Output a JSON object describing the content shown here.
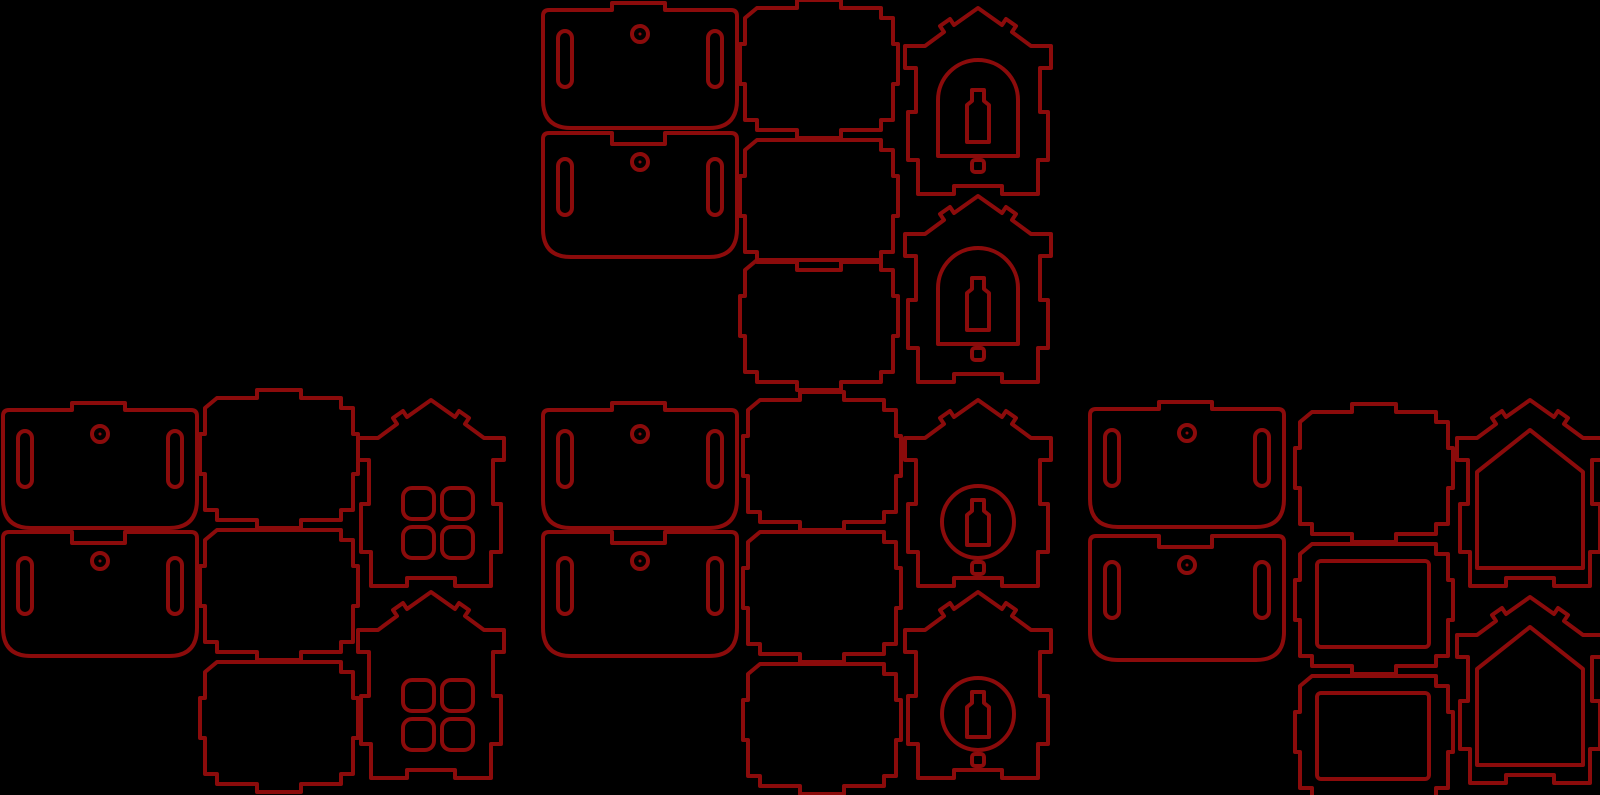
{
  "canvas": {
    "width": 1600,
    "height": 795,
    "background_color": "#000000",
    "line_color": "#8b0b0b",
    "line_width": 4
  },
  "sheet": {
    "kind": "laser-cut-layout",
    "kit_count": 4,
    "piece_count": 28
  },
  "geometry": {
    "roof": {
      "tab_path": "M0,97 V13 Q0,7 6,7 H69 V0 H122 V7 H188 Q194,7 194,13 V97 Q194,125 166,125 H28 Q0,125 0,97 Z",
      "notch_path": "M0,98 V8 Q0,2 6,2 H69 V13 H122 V2 H188 Q194,2 194,8 V98 Q194,126 166,126 H28 Q0,126 0,98 Z",
      "slots": [
        {
          "x": 15,
          "y": 28,
          "w": 14,
          "h": 56,
          "r": 7
        },
        {
          "x": 165,
          "y": 28,
          "w": 14,
          "h": 56,
          "r": 7
        }
      ],
      "hang_hole": {
        "cx": 97,
        "cy": 31,
        "r": 8,
        "dot_r": 1.5
      }
    },
    "wall": {
      "width": 148,
      "height": 122,
      "top_tab_segment": "H52 V-8 H96 V0 ",
      "top_plain_segment": "",
      "bottom_tab_segment": "H96 V130 H52 V122 ",
      "bottom_plain_segment": "",
      "body_template": "M12,0 {TOP}H136 V10 H148 V36 H153 V76 H148 V112 H136 V122 {BOTTOM}H12 V112 H0 V76 H-5 V36 H0 V10 Z",
      "rect_window": {
        "x": 17,
        "y": 17,
        "w": 112,
        "h": 86,
        "r": 4
      }
    },
    "gable": {
      "outline": "M73,0 L97,17 L101,11 L111,18 L107,24 L126,38 H146 V60 H135 V104 H143 V152 H133 V186 H97 V178 H49 V186 H13 V152 H3 V104 H11 V60 H0 V38 H20 L39,24 L35,18 L45,11 L49,17 Z",
      "windows": {
        "arch": {
          "arch_path": "M33,148 V92 A40,40 0 0 1 113,92 V148 Z",
          "bottle": {
            "top": 82,
            "bottom": 134
          },
          "hole": {
            "x": 67,
            "y": 152,
            "w": 12,
            "h": 12,
            "r": 3
          }
        },
        "circle": {
          "circle": {
            "cx": 73,
            "cy": 122,
            "r": 36
          },
          "bottle": {
            "top": 100,
            "bottom": 145
          },
          "hole": {
            "x": 67,
            "y": 162,
            "w": 12,
            "h": 12,
            "r": 3
          }
        },
        "four": {
          "holes": [
            [
              45,
              88
            ],
            [
              84,
              88
            ],
            [
              45,
              127
            ],
            [
              84,
              127
            ]
          ],
          "hole_size": 31,
          "hole_radius": 9
        },
        "house": {
          "path": "M73,30 L126,72 V168 H20 V72 Z"
        }
      }
    },
    "bottle": {
      "cap_left": 67,
      "cap_right": 79,
      "body_left": 62,
      "body_right": 84,
      "cap_drop": 11,
      "shoulder_drop": 15
    }
  },
  "pieces": [
    {
      "name": "roof-panel-tab",
      "kit": 1,
      "type": "roof-tab",
      "x": 543,
      "y": 3
    },
    {
      "name": "roof-panel-notch",
      "kit": 1,
      "type": "roof-notch",
      "x": 543,
      "y": 131
    },
    {
      "name": "wall-panel",
      "kit": 1,
      "type": "wall",
      "x": 745,
      "y": 8,
      "top_tab": true,
      "bottom_tab": true,
      "window": "none"
    },
    {
      "name": "wall-panel",
      "kit": 1,
      "type": "wall",
      "x": 745,
      "y": 140,
      "top_tab": false,
      "bottom_tab": true,
      "window": "none"
    },
    {
      "name": "wall-panel",
      "kit": 1,
      "type": "wall",
      "x": 745,
      "y": 260,
      "top_tab": false,
      "bottom_tab": true,
      "window": "none"
    },
    {
      "name": "gable-arch-window",
      "kit": 1,
      "type": "gable",
      "window": "arch",
      "x": 905,
      "y": 8
    },
    {
      "name": "gable-arch-window",
      "kit": 1,
      "type": "gable",
      "window": "arch",
      "x": 905,
      "y": 196
    },
    {
      "name": "roof-panel-tab",
      "kit": 2,
      "type": "roof-tab",
      "x": 3,
      "y": 403
    },
    {
      "name": "roof-panel-notch",
      "kit": 2,
      "type": "roof-notch",
      "x": 3,
      "y": 530
    },
    {
      "name": "wall-panel",
      "kit": 2,
      "type": "wall",
      "x": 205,
      "y": 398,
      "top_tab": true,
      "bottom_tab": true,
      "window": "none"
    },
    {
      "name": "wall-panel",
      "kit": 2,
      "type": "wall",
      "x": 205,
      "y": 530,
      "top_tab": false,
      "bottom_tab": true,
      "window": "none"
    },
    {
      "name": "wall-panel",
      "kit": 2,
      "type": "wall",
      "x": 205,
      "y": 662,
      "top_tab": false,
      "bottom_tab": true,
      "window": "none"
    },
    {
      "name": "gable-four-window",
      "kit": 2,
      "type": "gable",
      "window": "four",
      "x": 358,
      "y": 400
    },
    {
      "name": "gable-four-window",
      "kit": 2,
      "type": "gable",
      "window": "four",
      "x": 358,
      "y": 592
    },
    {
      "name": "roof-panel-tab",
      "kit": 3,
      "type": "roof-tab",
      "x": 543,
      "y": 403
    },
    {
      "name": "roof-panel-notch",
      "kit": 3,
      "type": "roof-notch",
      "x": 543,
      "y": 530
    },
    {
      "name": "wall-panel",
      "kit": 3,
      "type": "wall",
      "x": 748,
      "y": 400,
      "top_tab": true,
      "bottom_tab": true,
      "window": "none"
    },
    {
      "name": "wall-panel",
      "kit": 3,
      "type": "wall",
      "x": 748,
      "y": 532,
      "top_tab": false,
      "bottom_tab": true,
      "window": "none"
    },
    {
      "name": "wall-panel",
      "kit": 3,
      "type": "wall",
      "x": 748,
      "y": 664,
      "top_tab": false,
      "bottom_tab": true,
      "window": "none"
    },
    {
      "name": "gable-circle-window",
      "kit": 3,
      "type": "gable",
      "window": "circle",
      "x": 905,
      "y": 400
    },
    {
      "name": "gable-circle-window",
      "kit": 3,
      "type": "gable",
      "window": "circle",
      "x": 905,
      "y": 592
    },
    {
      "name": "roof-panel-tab",
      "kit": 4,
      "type": "roof-tab",
      "x": 1090,
      "y": 402
    },
    {
      "name": "roof-panel-notch",
      "kit": 4,
      "type": "roof-notch",
      "x": 1090,
      "y": 534
    },
    {
      "name": "wall-panel",
      "kit": 4,
      "type": "wall",
      "x": 1300,
      "y": 412,
      "top_tab": true,
      "bottom_tab": true,
      "window": "none"
    },
    {
      "name": "wall-panel-window",
      "kit": 4,
      "type": "wall",
      "x": 1300,
      "y": 544,
      "top_tab": false,
      "bottom_tab": true,
      "window": "rect"
    },
    {
      "name": "wall-panel-window",
      "kit": 4,
      "type": "wall",
      "x": 1300,
      "y": 676,
      "top_tab": false,
      "bottom_tab": true,
      "window": "rect"
    },
    {
      "name": "gable-house-window",
      "kit": 4,
      "type": "gable",
      "window": "house",
      "x": 1457,
      "y": 400
    },
    {
      "name": "gable-house-window",
      "kit": 4,
      "type": "gable",
      "window": "house",
      "x": 1457,
      "y": 597
    }
  ]
}
